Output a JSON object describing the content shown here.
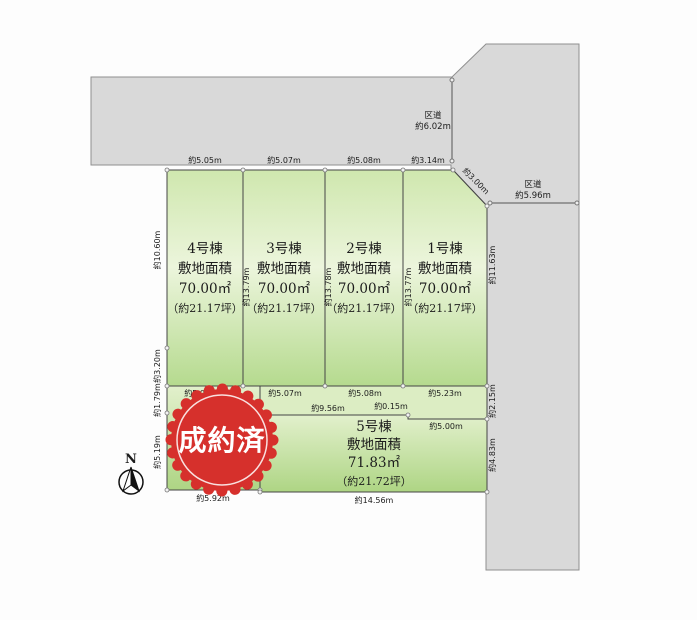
{
  "diagram": {
    "type": "real-estate-lot-layout",
    "colors": {
      "road_fill": "#d9d9d9",
      "road_stroke": "#8f8f8f",
      "plot_green_light": "#ecf5dc",
      "plot_green_mid": "#d2e8b2",
      "plot_green_dark": "#b5da8e",
      "plot_stroke": "#454545",
      "seal_red": "#d6302c",
      "seal_text": "#ffffff"
    }
  },
  "roads": {
    "top": {
      "name": "区道",
      "width_label": "約6.02m"
    },
    "right": {
      "name": "区道",
      "width_label": "約5.96m"
    }
  },
  "plots": [
    {
      "id": "4号棟",
      "area_caption": "敷地面積",
      "area_m2": "70.00㎡",
      "area_tsubo": "（約21.17坪）"
    },
    {
      "id": "3号棟",
      "area_caption": "敷地面積",
      "area_m2": "70.00㎡",
      "area_tsubo": "（約21.17坪）"
    },
    {
      "id": "2号棟",
      "area_caption": "敷地面積",
      "area_m2": "70.00㎡",
      "area_tsubo": "（約21.17坪）"
    },
    {
      "id": "1号棟",
      "area_caption": "敷地面積",
      "area_m2": "70.00㎡",
      "area_tsubo": "（約21.17坪）"
    },
    {
      "id": "5号棟",
      "area_caption": "敷地面積",
      "area_m2": "71.83㎡",
      "area_tsubo": "（約21.72坪）"
    }
  ],
  "dims": {
    "plot4_top": "約5.05m",
    "plot3_top": "約5.07m",
    "plot2_top": "約5.08m",
    "plot1_top": "約3.14m",
    "plot1_corner": "約3.00m",
    "plot1_right": "約11.63m",
    "right_strip": "約2.15m",
    "plot5_right": "約4.83m",
    "left_upper": "約10.60m",
    "left_mid": "約3.20m",
    "left_low": "約1.79m",
    "left_bottom": "約5.19m",
    "plot4_bottom": "約5.08m",
    "plot3_bottom": "約5.07m",
    "plot2_bottom": "約5.08m",
    "plot1_bottom": "約5.23m",
    "plot5_top_left": "約9.56m",
    "plot5_step": "約0.15m",
    "plot5_top_right": "約5.00m",
    "sold_bottom": "約5.92m",
    "plot5_bottom": "約14.56m",
    "sold_right": "約4.98m",
    "depth_4_3": "約13.79m",
    "depth_3_2": "約13.78m",
    "depth_2_1": "約13.77m"
  },
  "sold_seal": {
    "text": "成約済"
  },
  "compass": {
    "label": "N"
  }
}
